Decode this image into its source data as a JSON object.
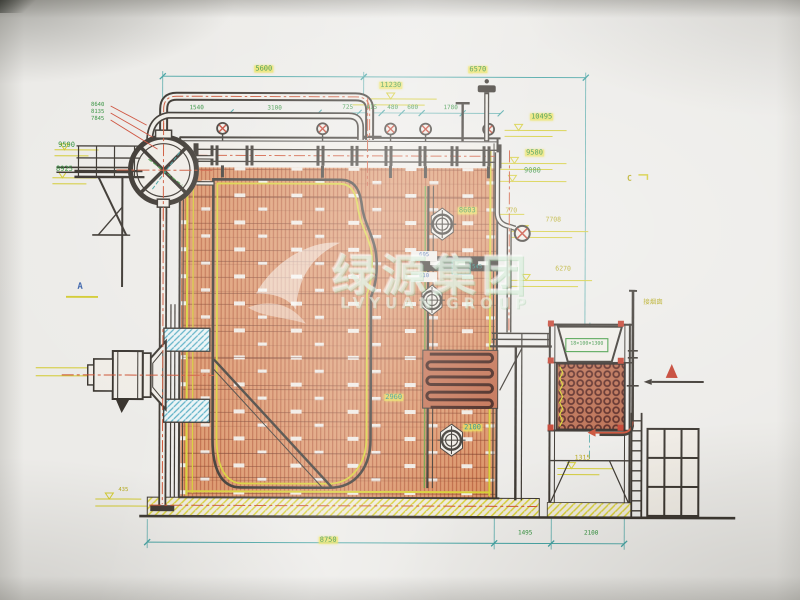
{
  "watermark": {
    "zh": "绿源集团",
    "en": "LVYUAN GROUP"
  },
  "section_markers": {
    "a": "A",
    "c": "C"
  },
  "annotations": {
    "flue_outlet": "接烟囱",
    "economizer_spec": "18×100×1300"
  },
  "dimensions": {
    "top": {
      "d5600": "5600",
      "d6570": "6570"
    },
    "spacing_row": {
      "d1540": "1540",
      "d3100": "3100",
      "d725": "725",
      "d415": "415",
      "d480": "480",
      "d600": "600",
      "d1780": "1780"
    },
    "bottom": {
      "d8750": "8750",
      "d1495": "1495",
      "d2100": "2100"
    }
  },
  "elevations": {
    "e11230": "11230",
    "e10495": "10495",
    "e9580": "9580",
    "e9080": "9080",
    "e9590": "9590",
    "e8925": "8925",
    "e8640": "8640",
    "e8135": "8135",
    "e7845": "7845",
    "e8603": "8603",
    "e770": "770",
    "e7708": "7708",
    "e6270": "6270",
    "e2960": "2960",
    "e2100": "2100",
    "e1315": "1315",
    "e435": "435",
    "e605": "605",
    "e610": "610",
    "e545": "545"
  },
  "colors": {
    "paper": "#efece6",
    "line_black": "#35302a",
    "tube_orange": "#db9265",
    "tube_line": "#b65a36",
    "insulation_yellow": "#d6ce2e",
    "dim_teal": "#3fa0a0",
    "dim_green": "#2f8f3a",
    "accent_blue": "#3a62aa",
    "refractory_cyan": "#4aa8c0",
    "centerline_red": "#cc5132",
    "coil_dark": "#54201a",
    "marker_red": "#c23a28"
  }
}
